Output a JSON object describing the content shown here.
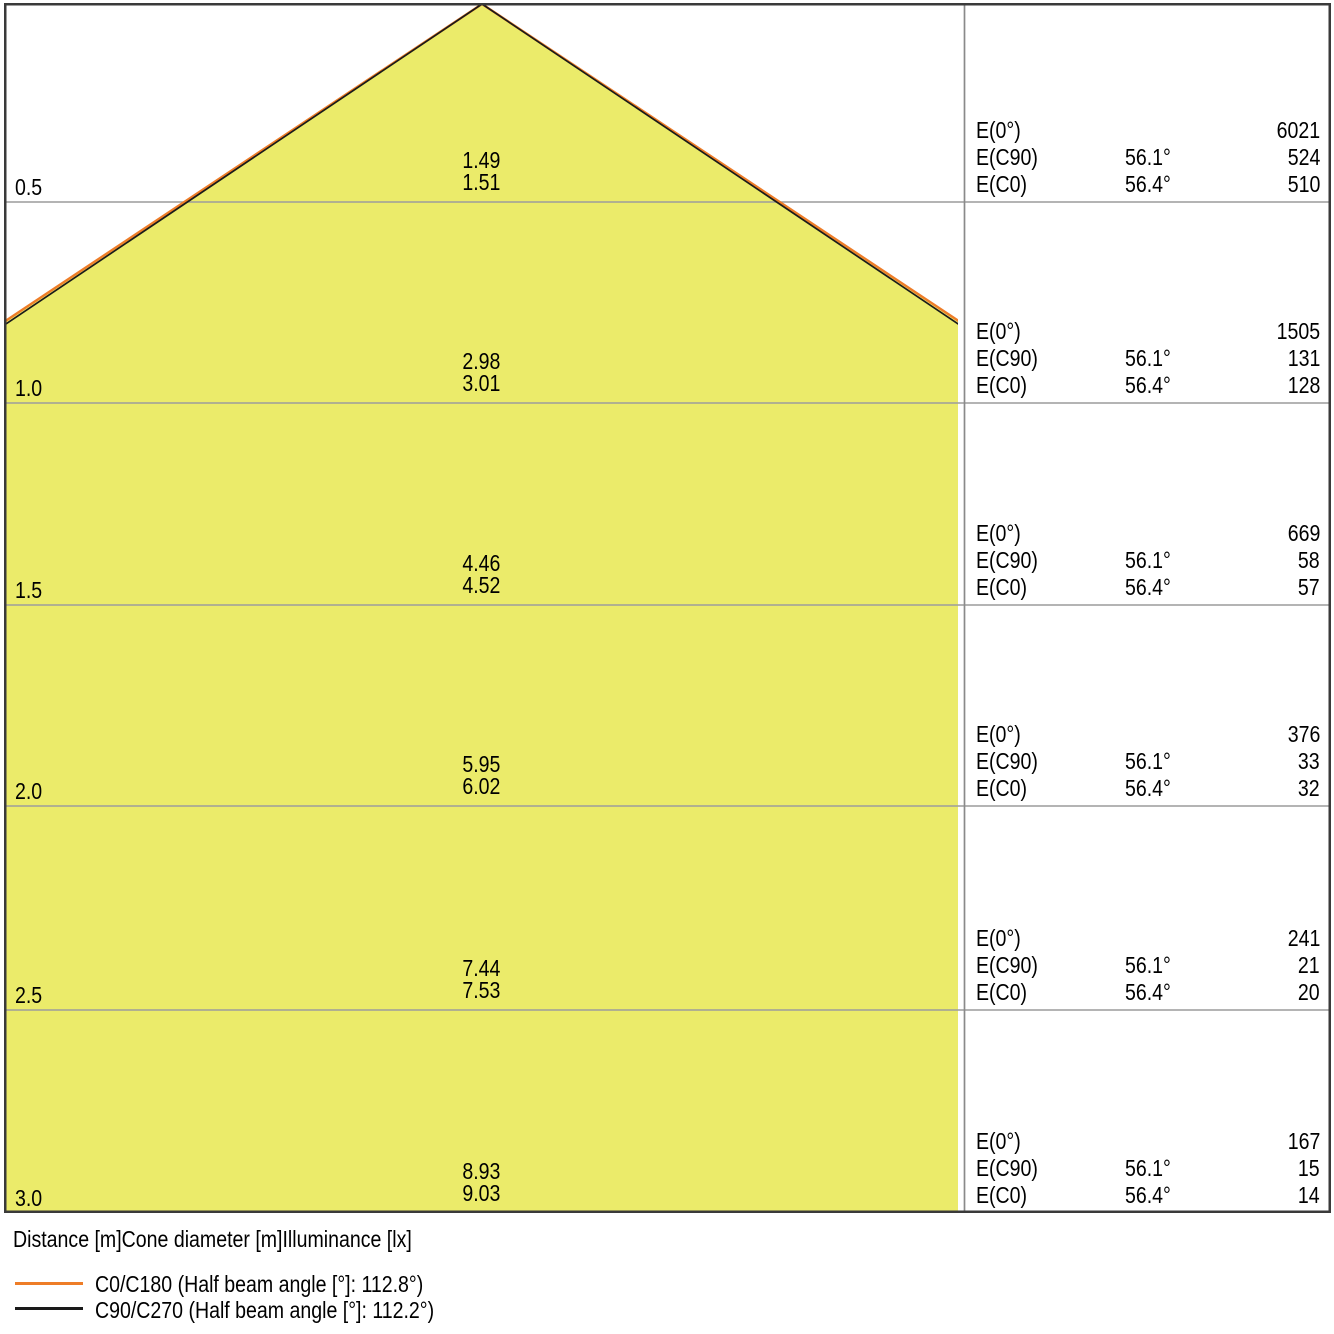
{
  "chart_data": {
    "type": "area",
    "axis_labels": {
      "distance": "Distance [m]",
      "cone_diameter": "Cone diameter [m]",
      "illuminance": "Illuminance [lx]"
    },
    "row_labels": {
      "e0": "E(0°)",
      "ec90": "E(C90)",
      "ec0": "E(C0)"
    },
    "beam_angles": {
      "ec90_half_angle": "56.1°",
      "ec0_half_angle": "56.4°",
      "c0_c180_half_beam_angle_deg": 112.8,
      "c90_c270_half_beam_angle_deg": 112.2
    },
    "rows": [
      {
        "distance": "0.5",
        "cone_diameter_c90": "1.49",
        "cone_diameter_c0": "1.51",
        "e0": "6021",
        "ec90_angle": "56.1°",
        "ec90": "524",
        "ec0_angle": "56.4°",
        "ec0": "510"
      },
      {
        "distance": "1.0",
        "cone_diameter_c90": "2.98",
        "cone_diameter_c0": "3.01",
        "e0": "1505",
        "ec90_angle": "56.1°",
        "ec90": "131",
        "ec0_angle": "56.4°",
        "ec0": "128"
      },
      {
        "distance": "1.5",
        "cone_diameter_c90": "4.46",
        "cone_diameter_c0": "4.52",
        "e0": "669",
        "ec90_angle": "56.1°",
        "ec90": "58",
        "ec0_angle": "56.4°",
        "ec0": "57"
      },
      {
        "distance": "2.0",
        "cone_diameter_c90": "5.95",
        "cone_diameter_c0": "6.02",
        "e0": "376",
        "ec90_angle": "56.1°",
        "ec90": "33",
        "ec0_angle": "56.4°",
        "ec0": "32"
      },
      {
        "distance": "2.5",
        "cone_diameter_c90": "7.44",
        "cone_diameter_c0": "7.53",
        "e0": "241",
        "ec90_angle": "56.1°",
        "ec90": "21",
        "ec0_angle": "56.4°",
        "ec0": "20"
      },
      {
        "distance": "3.0",
        "cone_diameter_c90": "8.93",
        "cone_diameter_c0": "9.03",
        "e0": "167",
        "ec90_angle": "56.1°",
        "ec90": "15",
        "ec0_angle": "56.4°",
        "ec0": "14"
      }
    ],
    "legend": [
      {
        "label": "C0/C180 (Half beam angle [°]: 112.8°)",
        "color": "#EE7D28"
      },
      {
        "label": "C90/C270 (Half beam angle [°]: 112.2°)",
        "color": "#1A1A1A"
      }
    ],
    "colors": {
      "cone_fill": "#EBEB6A",
      "c0_c180_line": "#EE7D28",
      "c90_c270_line": "#1A1A1A",
      "gridline": "#9C9C9C",
      "frame": "#3A3A3A"
    },
    "layout": {
      "grid": "on",
      "legend_position": "bottom-left",
      "distance_axis_range_m": [
        0,
        3.0
      ]
    }
  }
}
